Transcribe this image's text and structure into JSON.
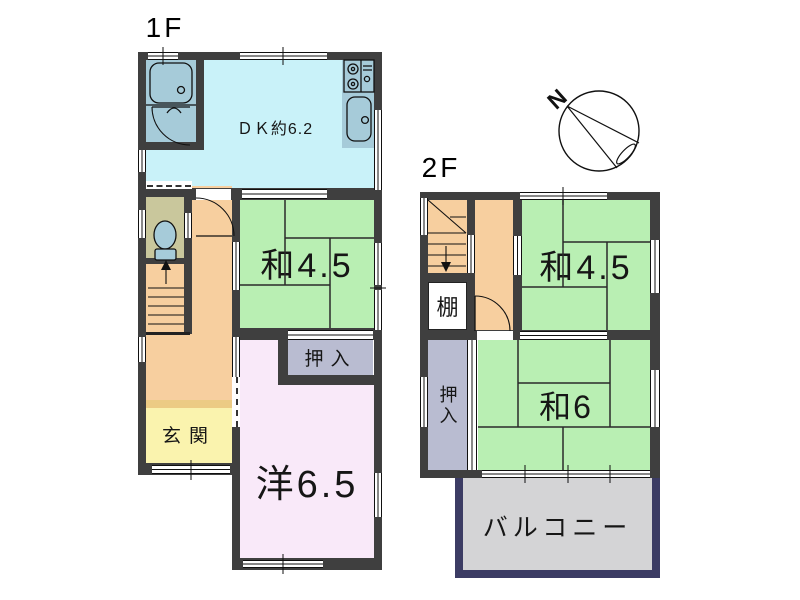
{
  "palette": {
    "wall": "#3f3f3f",
    "dk": "#c9f2f9",
    "bath": "#a6cbd9",
    "tatami": "#b9efb3",
    "hall": "#f7cf9f",
    "genkan": "#faf3ae",
    "genkan_step": "#eccb84",
    "toilet": "#c9c79c",
    "western": "#f9e9f9",
    "closet": "#b9bcd1",
    "shelf": "#ffffff",
    "balcony_fill": "#d4d4d6",
    "balcony_border": "#3c3c64",
    "line": "#111111"
  },
  "floor1": {
    "label": "1F",
    "rooms": {
      "dk": "ＤＫ約6.2",
      "washitsu": "和4.5",
      "oshiire": "押入",
      "genkan": "玄関",
      "youshitsu": "洋6.5"
    }
  },
  "floor2": {
    "label": "2F",
    "rooms": {
      "washitsu45": "和4.5",
      "washitsu6": "和6",
      "oshiire": "押入",
      "tana": "棚",
      "balcony": "バルコニー"
    }
  },
  "compass": {
    "north": "N"
  }
}
